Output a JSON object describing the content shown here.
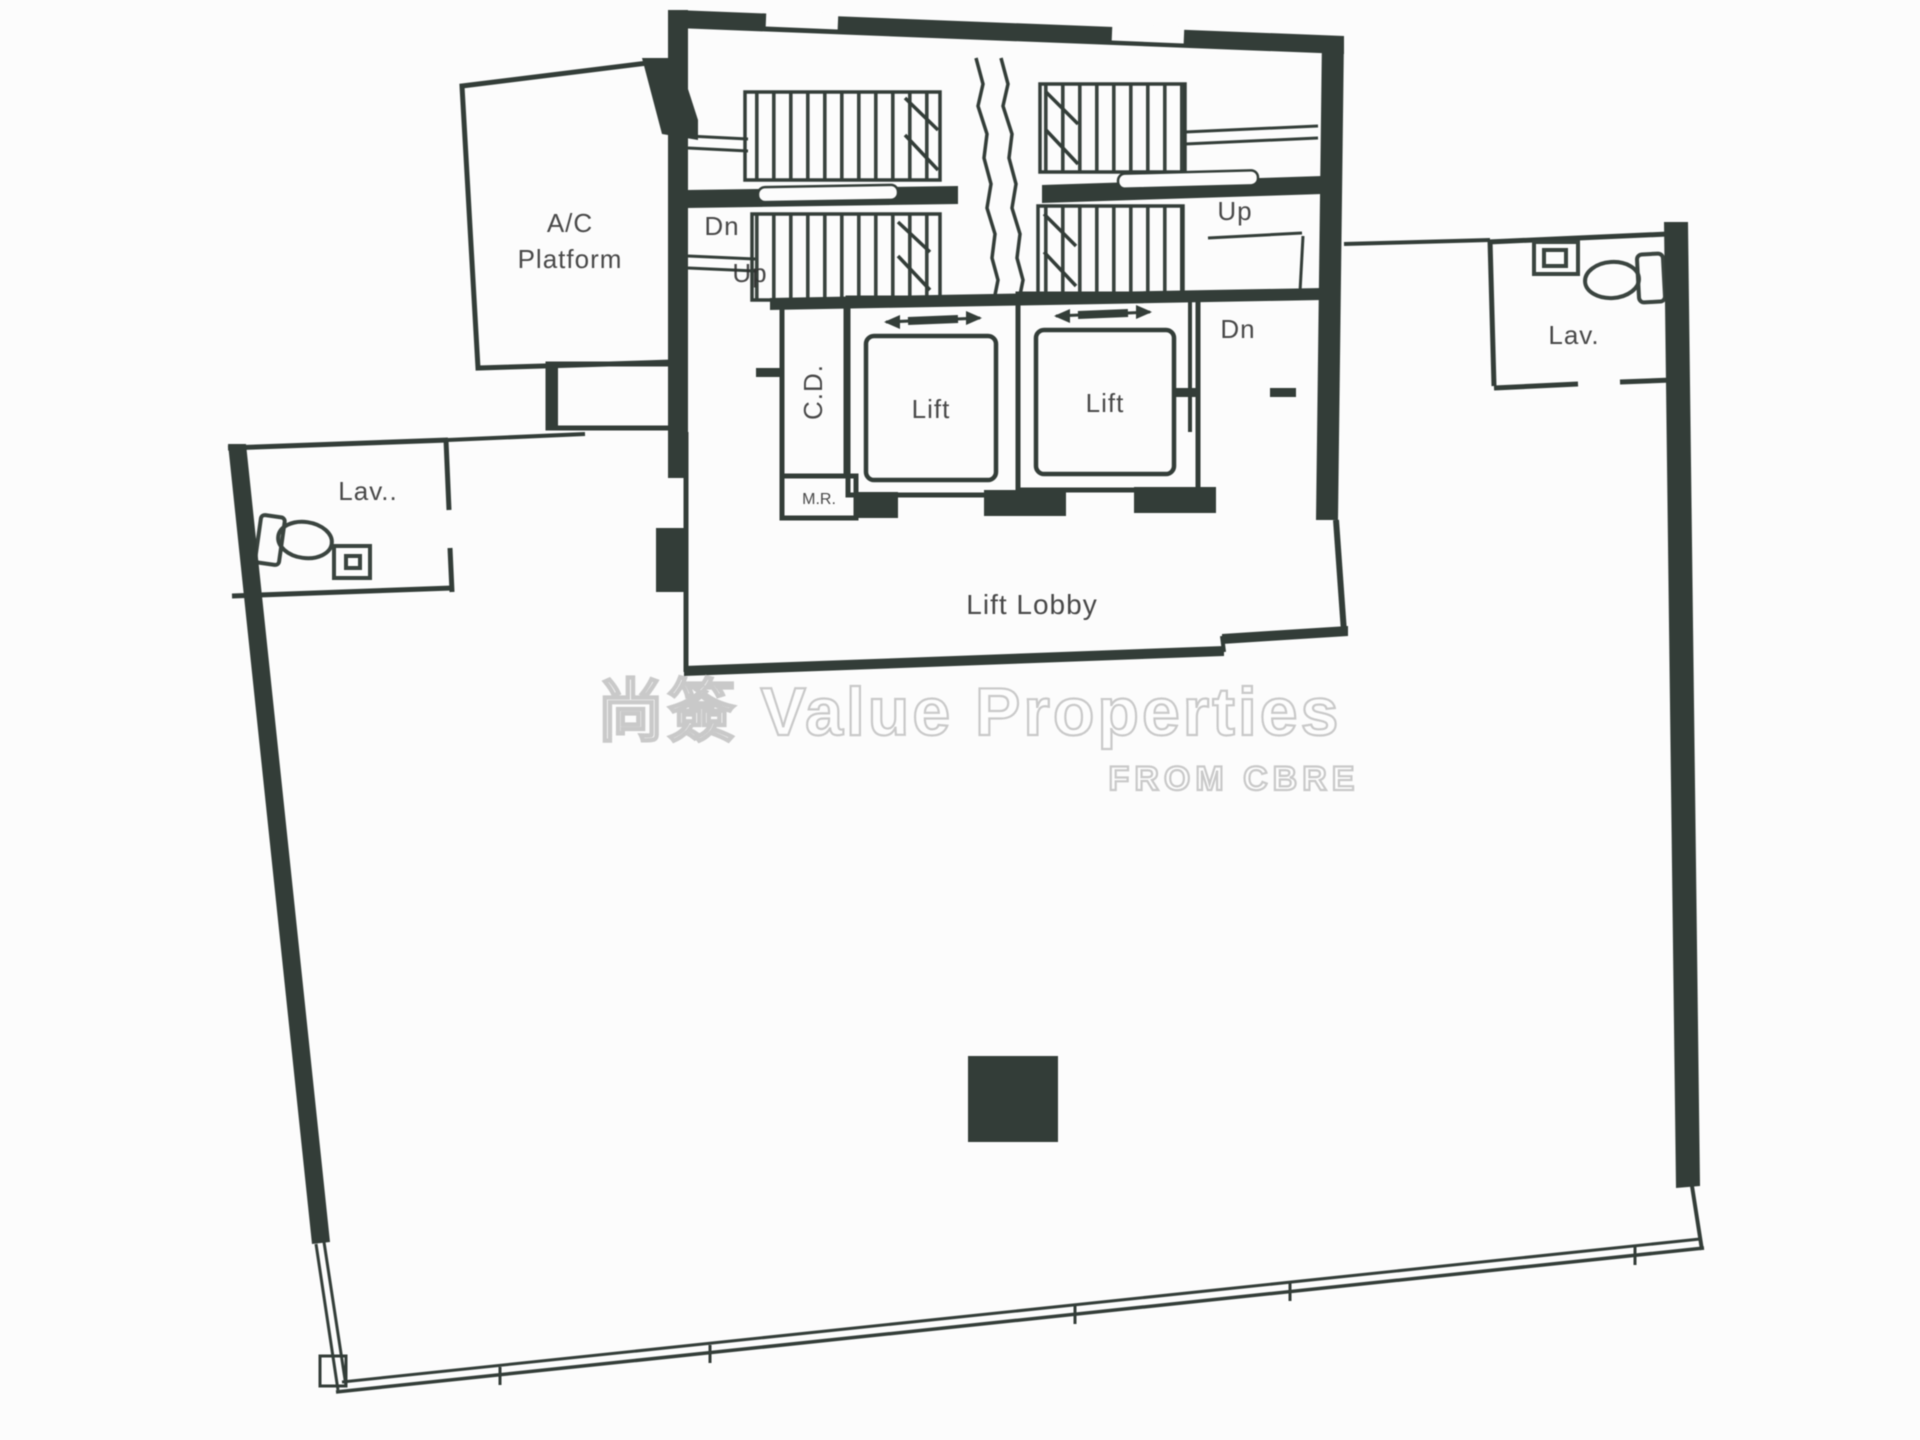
{
  "document": {
    "type": "floor-plan",
    "description": "Scanned office floor plan with central lift and stair core"
  },
  "colors": {
    "wall": "#333d38",
    "line": "#3a443f",
    "text": "#2f2f2f",
    "watermark": "#c4c4c4",
    "background": "#fcfcfc"
  },
  "rooms": {
    "ac_platform": {
      "line1": "A/C",
      "line2": "Platform"
    },
    "cable_duct": {
      "label": "C.D."
    },
    "meter_room": {
      "label": "M.R."
    },
    "lift_1": {
      "label": "Lift"
    },
    "lift_2": {
      "label": "Lift"
    },
    "lift_lobby": {
      "label": "Lift Lobby"
    },
    "lav_left": {
      "label": "Lav.."
    },
    "lav_right": {
      "label": "Lav."
    }
  },
  "stairs": {
    "left_down": "Dn",
    "left_up": "Up",
    "right_up": "Up",
    "right_down": "Dn"
  },
  "watermark": {
    "line1": "尚簽 Value Properties",
    "line2": "FROM CBRE"
  }
}
